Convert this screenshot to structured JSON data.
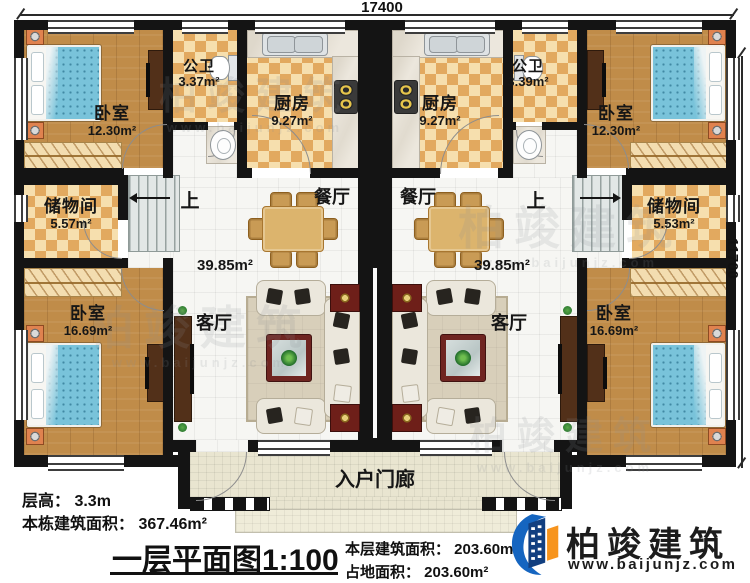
{
  "dimensions": {
    "top": "17400",
    "right": "11700"
  },
  "rooms": {
    "bedroom_top_left": {
      "name": "卧室",
      "area": "12.30m²"
    },
    "bath_left": {
      "name": "公卫",
      "area": "3.37m²"
    },
    "kitchen_left": {
      "name": "厨房",
      "area": "9.27m²"
    },
    "kitchen_right": {
      "name": "厨房",
      "area": "9.27m²"
    },
    "bath_right": {
      "name": "公卫",
      "area": "3.39m²"
    },
    "bedroom_top_right": {
      "name": "卧室",
      "area": "12.30m²"
    },
    "storage_left": {
      "name": "储物间",
      "area": "5.57m²"
    },
    "storage_right": {
      "name": "储物间",
      "area": "5.53m²"
    },
    "stairs_left": {
      "label": "上"
    },
    "stairs_right": {
      "label": "上"
    },
    "dining_left": {
      "name": "餐厅"
    },
    "dining_right": {
      "name": "餐厅"
    },
    "hall_left": {
      "area": "39.85m²"
    },
    "hall_right": {
      "area": "39.85m²"
    },
    "living_left": {
      "name": "客厅"
    },
    "living_right": {
      "name": "客厅"
    },
    "bedroom_bottom_left": {
      "name": "卧室",
      "area": "16.69m²"
    },
    "bedroom_bottom_right": {
      "name": "卧室",
      "area": "16.69m²"
    },
    "porch": {
      "name": "入户门廊"
    }
  },
  "footer": {
    "floor_height": "层高： 3.3m",
    "building_area": "本栋建筑面积： 367.46m²",
    "title": "一层平面图1:100",
    "floor_area": "本层建筑面积： 203.60m²",
    "footprint": "占地面积： 203.60m²"
  },
  "brand": {
    "name": "柏竣建筑",
    "site": "www.baijunjz.com"
  },
  "watermark": {
    "name": "柏竣建筑",
    "site": "www.baijunjz.com"
  },
  "colors": {
    "wall": "#141414",
    "checker_dark": "#e2a95f",
    "checker_light": "#f6dfae",
    "wood": "#c08c49",
    "bed_blue": "#79c3da",
    "brand_blue": "#1565c0",
    "brand_orange": "#f7941d"
  }
}
